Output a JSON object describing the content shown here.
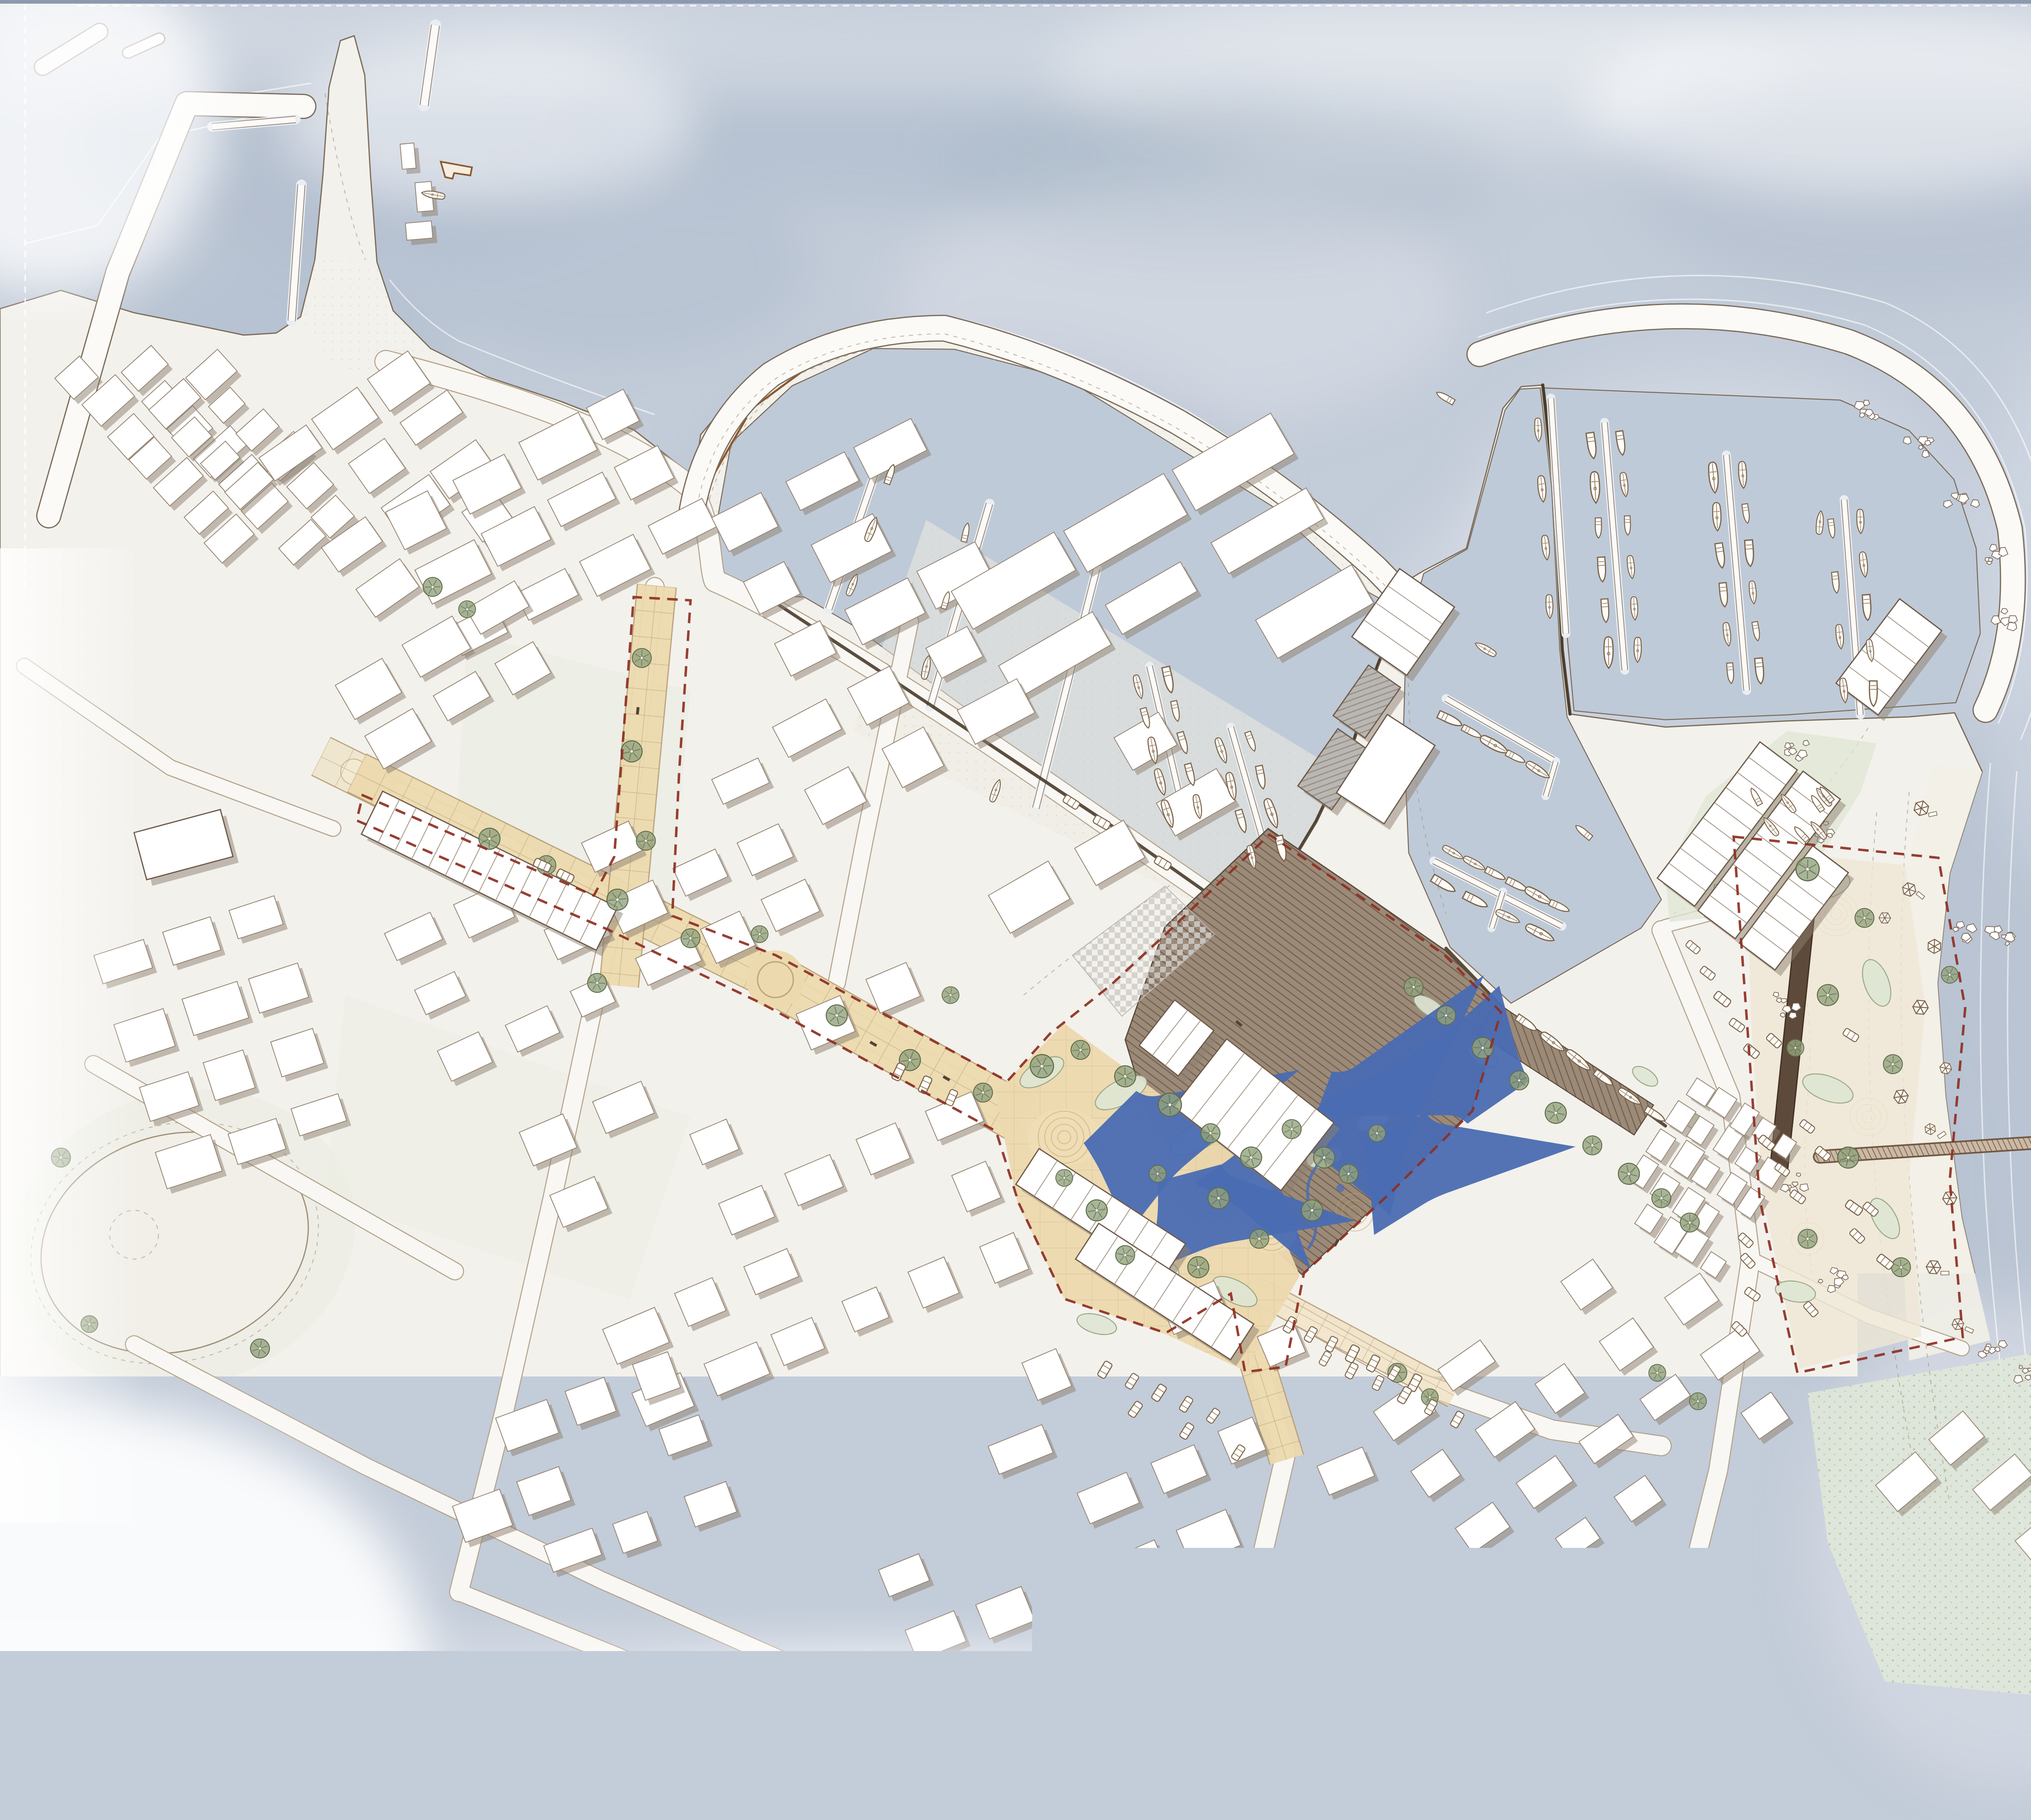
{
  "document": {
    "type": "architectural-masterplan-site-plan",
    "description": "Watercolor-style coastal harbor town masterplan, plan view: two marina basins with breakwaters and moored boats, a beige paved pedestrian high street with red dashed project boundary, a timber-deck harbor square with market sheds and shade sails, beach promenade with long pier, dune garden, wetland meadow and dense white building fabric with cast shadows",
    "visible_text": "none"
  },
  "canvas": {
    "width": 5296,
    "height": 4481
  },
  "palette": {
    "paper": "#fcfcfb",
    "water": "#c3ccd9",
    "waterBasin": "#bfcad8",
    "waterDeep": "#a8b5c8",
    "waterLight": "#dde2ea",
    "land": "#f3f1ec",
    "landDot": "#ccc4b6",
    "coast": "#7c6c59",
    "terrline": "#a08f77",
    "road": "#f8f7f3",
    "roadedge": "#b3a28a",
    "breakwater": "#fbfaf7",
    "bld": "#ffffff",
    "bldline": "#968573",
    "shadow": "#8d8070",
    "street": "#ecd9ae",
    "streetline": "#b49a72",
    "red": "#8e2f22",
    "deckA": "#9c8a79",
    "deckB": "#6f5b4a",
    "sand": "#eeddb6",
    "sandline": "#c89d5c",
    "green": "#93a37e",
    "greenDark": "#5f6e4b",
    "greenFill": "#dfe6d4",
    "greenDot": "#a4b491",
    "sailBlue": "#7e95c4",
    "stream": "#4a6cb3",
    "quay": "#40301f",
    "ink": "#7d6549",
    "rock": "#7d6856",
    "fence": "#8a5a30",
    "frameBar": "#8c99ae"
  },
  "features": [
    "open-sea-watercolor-wash",
    "northwest-breakwater-harbor",
    "peninsula-with-pier",
    "west-marina-basin-with-curved-mole-and-jetties",
    "east-marina-basin-with-curved-breakwater-and-jetties",
    "central-harbor-point-with-boat-sheds",
    "moored-sailboats-and-motorboats",
    "pedestrian-high-street-beige-paving",
    "north-cross-street-spur",
    "harbor-square-timber-deck-with-market-sheds",
    "shade-sails-and-water-play-stream",
    "planting-islands-and-street-trees",
    "red-dashed-project-boundary",
    "parking-rows-with-cars",
    "beach-with-parasols-and-rock-groynes",
    "long-timber-pier-into-sea",
    "dune-garden",
    "wetland-meadow",
    "sports-field-oval-park",
    "residential-blocks-with-cast-shadows"
  ]
}
